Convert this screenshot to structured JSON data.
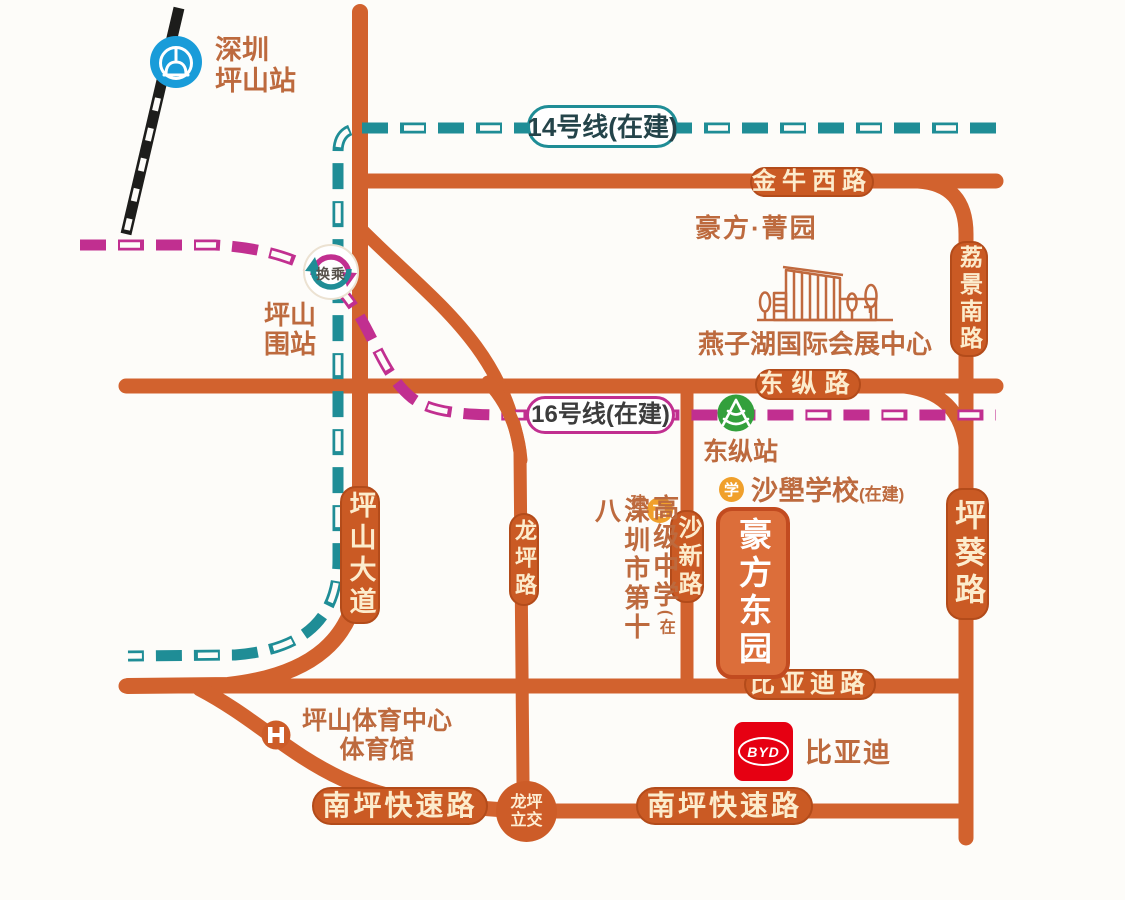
{
  "colors": {
    "road": "#d2622e",
    "road_pill_bg": "#ca5a24",
    "road_pill_text": "#fceccd",
    "line14_teal": "#1f8d96",
    "line16_magenta": "#c12f90",
    "place_text_brown": "#bd6a3e",
    "railway_black": "#1d1d1b",
    "national_rail_blue": "#199cd9",
    "metro_green": "#33a03c",
    "school_badge_orange": "#f0a02b",
    "byd_red": "#e60012",
    "project_fill": "#dc6e3a",
    "project_border": "#c24b20"
  },
  "metro": {
    "line14_label": "14号线(在建)",
    "line16_label": "16号线(在建)",
    "transfer_label": "换乘"
  },
  "stations": {
    "shenzhen_pingshan": {
      "line1": "深圳",
      "line2": "坪山站"
    },
    "pingshanwei": {
      "line1": "坪山",
      "line2": "围站"
    },
    "dongzong": {
      "name": "东纵站"
    }
  },
  "roads": {
    "jinniu_west_road": "金牛西路",
    "lijing_south_road": "荔景南路",
    "dongzong_road": "东纵路",
    "pingshan_avenue": "坪山大道",
    "longping_road": "龙坪路",
    "shaxin_road": "沙新路",
    "pingkui_road": "坪葵路",
    "biyadi_road": "比亚迪路",
    "nanping_expressway": "南坪快速路",
    "longping_interchange_line1": "龙坪",
    "longping_interchange_line2": "立交"
  },
  "places": {
    "haofang_jingyuan": "豪方·菁园",
    "yanzihu_center": "燕子湖国际会展中心",
    "shaxue_school_name": "沙壆学校",
    "shaxue_school_status": "(在建)",
    "school_badge_xue": "学",
    "school_badge_gao": "高",
    "no18_school_col1": "高级中学",
    "no18_school_status": "(在建)",
    "no18_school_col2": "深圳市第十八",
    "project_name": "豪方东园",
    "sports_center_line1": "坪山体育中心",
    "sports_center_line2": "体育馆",
    "byd_logo": "BYD",
    "byd_name": "比亚迪"
  }
}
